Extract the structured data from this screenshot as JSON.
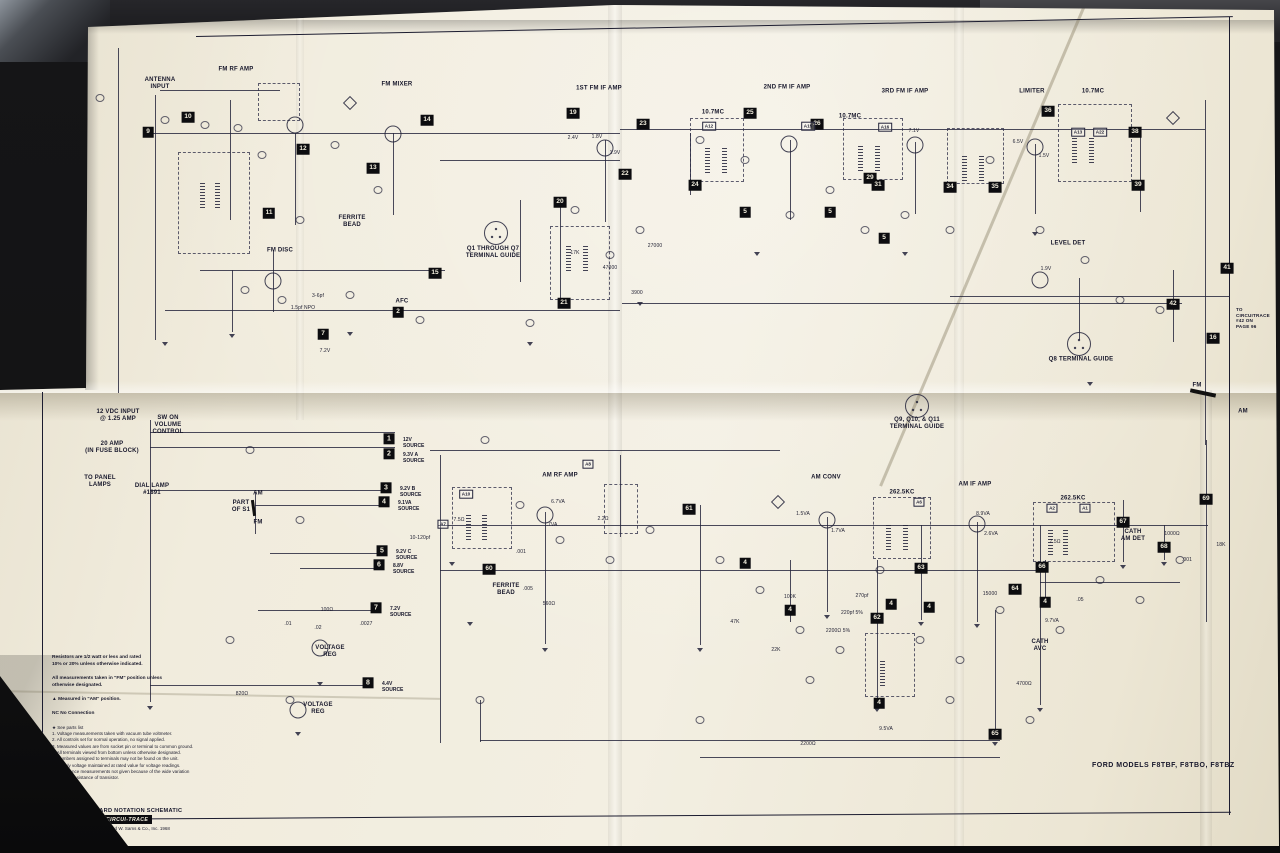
{
  "photo": {
    "background": "#131315",
    "paper_color": "#f1ecdd",
    "ink_color": "#23233a",
    "callout_bg": "#0c0c0f"
  },
  "labels": {
    "antenna_input": "ANTENNA\nINPUT",
    "fm_rf_amp": "FM RF AMP",
    "fm_mixer": "FM MIXER",
    "fm_if1": "1ST FM IF AMP",
    "fm_if2": "2ND FM IF AMP",
    "fm_if3": "3RD FM IF AMP",
    "limiter": "LIMITER",
    "mc107": "10.7MC",
    "fm_disc": "FM DISC",
    "level_det": "LEVEL DET",
    "q1q7": "Q1 THROUGH Q7\nTERMINAL GUIDE",
    "q8": "Q8 TERMINAL GUIDE",
    "q911": "Q9, Q10, & Q11\nTERMINAL GUIDE",
    "ferrite_bead": "FERRITE\nBEAD",
    "am_rf_amp": "AM RF AMP",
    "am_conv": "AM CONV",
    "am_if_amp": "AM IF AMP",
    "kc2625": "262.5KC",
    "cath_avc": "CATH\nAVC",
    "cath_det": "CATH\nAM DET",
    "volt_reg": "VOLTAGE\nREG",
    "vdc": "12 VDC INPUT\n@ 1.25 AMP",
    "fuse": "20 AMP\n(IN FUSE BLOCK)",
    "panel": "TO PANEL\nLAMPS",
    "dial": "DIAL LAMP\n#1891",
    "swon": "SW ON\nVOLUME\nCONTROL",
    "part_s1": "PART\nOF S1",
    "am_sm": "AM",
    "fm_sm": "FM",
    "circ42": "TO\nCIRCUITRACE\n#42 ON\nPAGE 96",
    "afc": "AFC"
  },
  "sources": [
    {
      "num": "1",
      "label": "12V\nSOURCE"
    },
    {
      "num": "2",
      "label": "9.3V A\nSOURCE"
    },
    {
      "num": "3",
      "label": "9.2V B\nSOURCE"
    },
    {
      "num": "4",
      "label": "9.1VA\nSOURCE"
    },
    {
      "num": "5",
      "label": "9.2V C\nSOURCE"
    },
    {
      "num": "6",
      "label": "8.8V\nSOURCE"
    },
    {
      "num": "7",
      "label": "7.2V\nSOURCE"
    },
    {
      "num": "8",
      "label": "4.4V\nSOURCE"
    }
  ],
  "callouts": [
    "9",
    "10",
    "11",
    "12",
    "13",
    "14",
    "15",
    "16",
    "19",
    "20",
    "21",
    "22",
    "23",
    "24",
    "25",
    "26",
    "29",
    "31",
    "34",
    "35",
    "36",
    "38",
    "39",
    "41",
    "42",
    "2",
    "7",
    "5",
    "5",
    "5",
    "60",
    "61",
    "62",
    "63",
    "64",
    "65",
    "66",
    "67",
    "68",
    "69",
    "4",
    "4",
    "4",
    "4",
    "4",
    "4"
  ],
  "aboxes": [
    "A12",
    "A15",
    "A16",
    "A13",
    "A22",
    "A10",
    "A7",
    "A8",
    "A1",
    "A2",
    "A6"
  ],
  "values": [
    "17K",
    "47000",
    "27000",
    "3900",
    "2200Ω",
    "47K",
    "22K",
    "100K",
    "2200Ω 5%",
    "220pf 5%",
    "270pf",
    "15000",
    ".05",
    "9.7VA",
    "4700Ω",
    "1000Ω",
    "18K",
    ".001",
    "7.5Ω",
    "560Ω",
    ".005",
    ".001",
    "7.5Ω",
    "10-120pf",
    "2.2Ω",
    "100Ω",
    ".01",
    ".02",
    ".0027",
    "820Ω",
    "9.5VA",
    "1.7VA",
    "1.5VA",
    "8.9VA",
    "2.6VA",
    "6.7VA",
    ".7VA",
    "7.2V",
    "1.5pf NPO",
    "3-6pf",
    "1.8V",
    "1.9V",
    "2.4V",
    "7.1V",
    "6.5V",
    "1.5V",
    "1.9V"
  ],
  "notes": {
    "resistors": "Resistors are 1/2 watt or less and rated\n10% or 20% unless otherwise indicated.",
    "measurements": "All measurements taken in \"FM\" position unless\notherwise designated.",
    "am_position": "▲ Measured in \"AM\" position.",
    "nc": "NC  No Connection",
    "list": [
      "★  See parts list",
      "1.  Voltage measurements taken with vacuum tube voltmeter.",
      "2.  All controls set for normal operation, no signal applied.",
      "3.  Measured values are from socket pin or terminal to common ground.",
      "4.  All terminals viewed from bottom unless otherwise designated.",
      "5.  Numbers assigned to terminals may not be found on the unit.",
      "6.  Supply voltage maintained at rated value for voltage readings.",
      "7.  Resistance measurements not given because of the wide variation\n      in internal resistance of transistor."
    ]
  },
  "footer": {
    "line1": "A PHOTOFACT STANDARD NOTATION SCHEMATIC",
    "with_text": "with",
    "badge": "CIRCUI-TRACE",
    "copyright": "© Howard W. Sams & Co., Inc. 1968",
    "models": "FORD MODELS F8TBF, F8TBO, F8TBZ"
  }
}
